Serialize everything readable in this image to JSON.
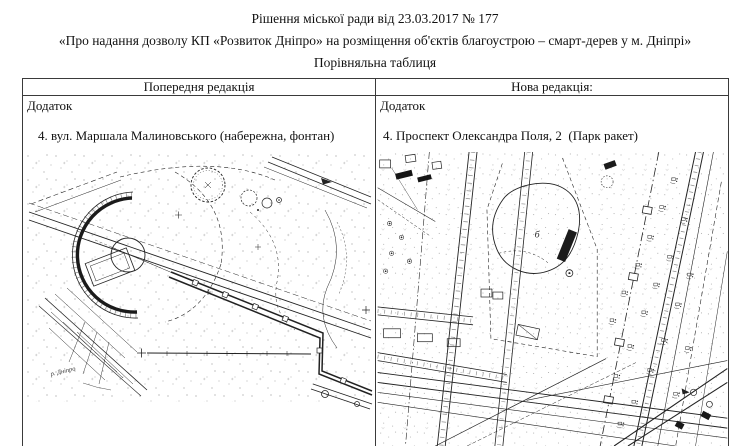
{
  "document": {
    "title_line1": "Рішення міської ради від 23.03.2017 № 177",
    "title_line2": "«Про надання дозволу КП «Розвиток Дніпро» на розміщення об'єктів благоустрою – смарт-дерев у м. Дніпрі»",
    "title_line3": "Порівняльна таблиця"
  },
  "table": {
    "previous": {
      "header": "Попередня редакція",
      "annex": "Додаток",
      "item": "4. вул. Маршала Малиновського (набережна, фонтан)",
      "river_label": "р. Дніпро"
    },
    "new": {
      "header": "Нова редакція:",
      "annex": "Додаток",
      "item": "4. Проспект Олександра Поля, 2  (Парк ракет)",
      "building_label": "б"
    }
  }
}
